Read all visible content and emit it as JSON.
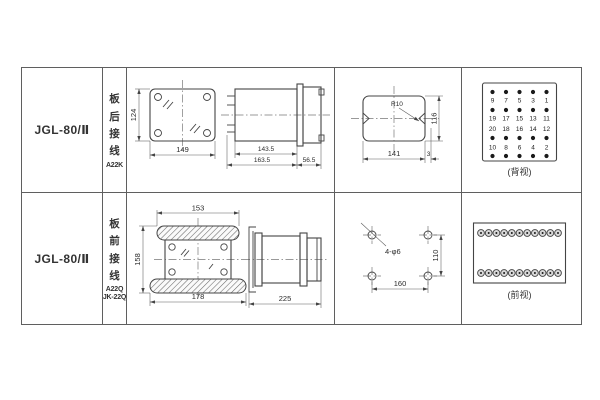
{
  "sheet": {
    "rows": [
      {
        "model": "JGL-80/Ⅱ",
        "wiring_chars": [
          "板",
          "后",
          "接",
          "线"
        ],
        "wiring_codes": [
          "A22K"
        ],
        "mount_view": {
          "height": "124",
          "width": "149"
        },
        "side_view": {
          "case": "143.5",
          "overall": "163.5",
          "rear": "56.5"
        },
        "cutout_view": {
          "radius": "R10",
          "width": "141",
          "offset": "3",
          "height": "116"
        },
        "terminal_view": {
          "caption": "(背视)",
          "numbers": [
            [
              "9",
              "7",
              "5",
              "3",
              "1"
            ],
            [
              "19",
              "17",
              "15",
              "13",
              "11"
            ],
            [
              "20",
              "18",
              "16",
              "14",
              "12"
            ],
            [
              "10",
              "8",
              "6",
              "4",
              "2"
            ]
          ]
        }
      },
      {
        "model": "JGL-80/Ⅱ",
        "wiring_chars": [
          "板",
          "前",
          "接",
          "线"
        ],
        "wiring_codes": [
          "A22Q",
          "JK-22Q"
        ],
        "mount_view": {
          "top": "153",
          "height": "158",
          "bottom": "178"
        },
        "side_view": {
          "overall": "225"
        },
        "drill_view": {
          "holes": "4-φ6",
          "height": "110",
          "width": "160"
        },
        "terminal_view": {
          "caption": "(前视)"
        }
      }
    ]
  }
}
